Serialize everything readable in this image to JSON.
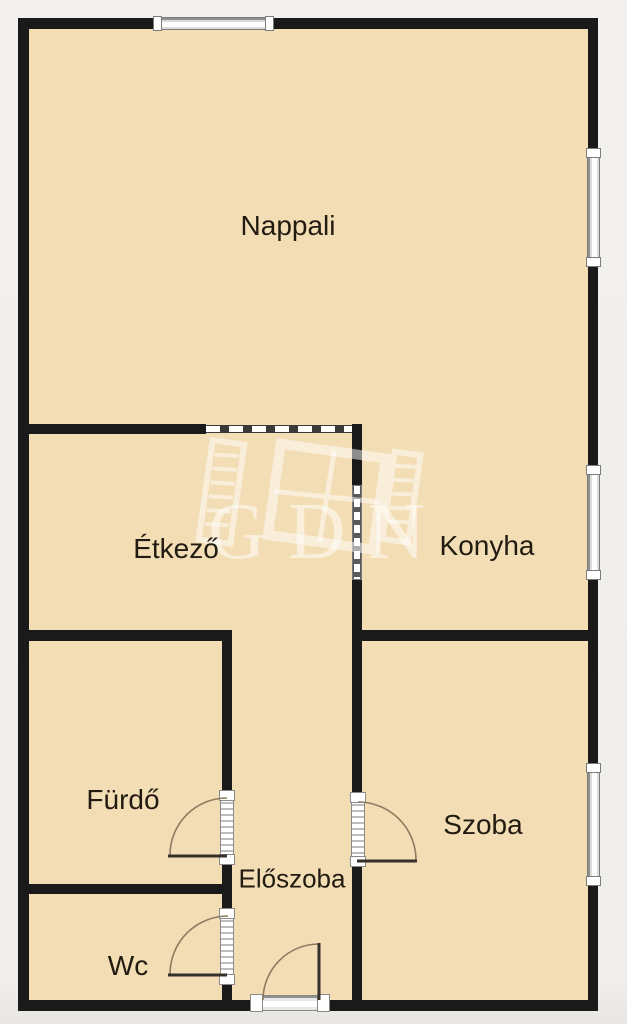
{
  "plan_type": "floor-plan",
  "colors": {
    "background": "#f0eeea",
    "floor": "#f3ddb5",
    "wall": "#1a1a1a",
    "window_frame": "#8f8f8f",
    "door_arc": "#8c7b60"
  },
  "rooms": [
    {
      "name": "nappali",
      "label": "Nappali"
    },
    {
      "name": "etkezo",
      "label": "Étkező"
    },
    {
      "name": "konyha",
      "label": "Konyha"
    },
    {
      "name": "furdo",
      "label": "Fürdő"
    },
    {
      "name": "eloszoba",
      "label": "Előszoba"
    },
    {
      "name": "wc",
      "label": "Wc"
    },
    {
      "name": "szoba",
      "label": "Szoba"
    }
  ],
  "watermark": {
    "text": "GDN"
  },
  "features": {
    "windows": [
      "top-wall-window",
      "right-wall-window-nappali",
      "right-wall-window-konyha",
      "right-wall-window-szoba"
    ],
    "doors": [
      "furdo-door",
      "wc-door",
      "szoba-door",
      "entrance-door",
      "etkezo-konyha-door"
    ],
    "openings": [
      "nappali-etkezo-opening"
    ]
  }
}
